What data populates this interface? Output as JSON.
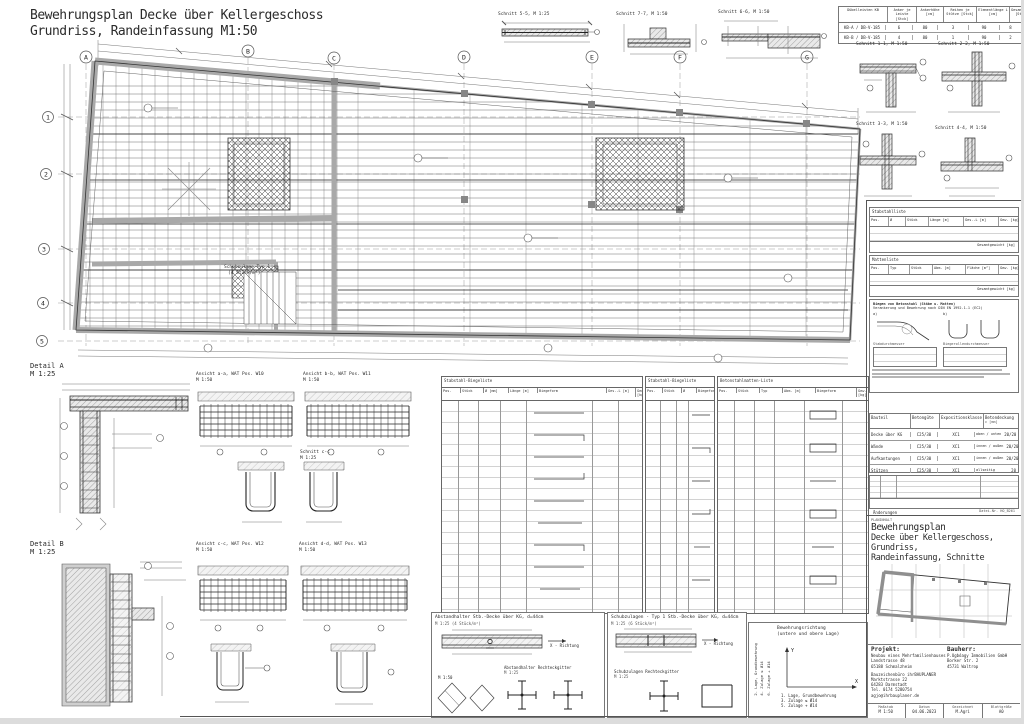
{
  "sheet": {
    "title1": "Bewehrungsplan Decke über Kellergeschoss",
    "title2": "Grundriss, Randeinfassung M1:50",
    "file_no": "Datei-Nr. HO_B261"
  },
  "plan": {
    "grid_top": [
      "A",
      "B",
      "C",
      "D",
      "E",
      "F",
      "G"
    ],
    "grid_left": [
      "1",
      "2",
      "3",
      "4",
      "5"
    ],
    "note1": "Schubzulage Typ 1",
    "note2": "(4 Stück/m²)"
  },
  "top_sections": [
    {
      "label": "Schnitt 5-5, M 1:25"
    },
    {
      "label": "Schnitt 7-7, M 1:50"
    },
    {
      "label": "Schnitt 6-6, M 1:50"
    }
  ],
  "right_sections": [
    {
      "label": "Schnitt 1-1, M 1:50"
    },
    {
      "label": "Schnitt 2-2, M 1:50"
    },
    {
      "label": "Schnitt 3-3, M 1:50"
    },
    {
      "label": "Schnitt 4-4, M 1:50"
    }
  ],
  "anchor_table": {
    "columns": [
      "Dübelleisten KB",
      "Anker je Leiste [Stck]",
      "Ankerhöhe [cm]",
      "Reihen je Stütze [Stck]",
      "Elementlänge L [cm]",
      "Gesamtzahl [Stck]"
    ],
    "rows": [
      [
        "KB-A / DB-V-185",
        "6",
        "80",
        "3",
        "90",
        "8"
      ],
      [
        "KB-B / DB-V-185",
        "4",
        "80",
        "1",
        "90",
        "2"
      ]
    ]
  },
  "left_details": {
    "detail_a_title": "Detail A",
    "detail_a_scale": "M 1:25",
    "detail_b_title": "Detail B",
    "detail_b_scale": "M 1:25",
    "ansicht_aa": "Ansicht a-a, WAT Pos. W10",
    "ansicht_aa_scale": "M 1:50",
    "ansicht_bb": "Ansicht b-b, WAT Pos. W11",
    "ansicht_bb_scale": "M 1:50",
    "schnitt_cc": "Schnitt c-c",
    "schnitt_cc_scale": "M 1:25",
    "ansicht_cc": "Ansicht c-c, WAT Pos. W12",
    "ansicht_cc_scale": "M 1:50",
    "ansicht_dd": "Ansicht d-d, WAT Pos. W13",
    "ansicht_dd_scale": "M 1:50"
  },
  "schedules": {
    "t1_title": "Stabstahl-Biegeliste",
    "t2_title": "Stabstahl-Biegeliste",
    "t3_title": "Betonstahlmatten-Liste",
    "headers": [
      "Pos.",
      "Stück",
      "Ø [mm]",
      "Länge [m]",
      "Biegeform",
      "Ges.-L [m]",
      "Gew. [kg]"
    ],
    "headers_short": [
      "Pos.",
      "Stück",
      "Ø",
      "Biegeform"
    ],
    "headers_matten": [
      "Pos.",
      "Stück",
      "Typ",
      "Abm. [m]",
      "Biegeform",
      "Gew. [kg]"
    ]
  },
  "bottom": {
    "box1_title": "Abstandhalter  Stb.-Decke über KG, d=44cm",
    "box1_scale": "M 1:25  (4 Stück/m²)",
    "box1_sub": "Abstandhalter Rechteckgitter",
    "box1_sub_scale": "M 1:25",
    "box2_title": "Schubzulagen - Typ 1 Stb.-Decke über KG, d=44cm",
    "box2_scale": "M 1:25  (6 Stück/m²)",
    "box2_sub": "Schubzulagen Rechteckgitter",
    "box2_sub_scale": "M 1:25",
    "x_richtung": "X - Richtung",
    "m150": "M 1:50"
  },
  "legend": {
    "title1": "Bewehrungsrichtung",
    "title2": "(untere und obere Lage)",
    "x": "X",
    "y": "Y",
    "x_lines": [
      "1. Lage, Grundbewehrung",
      "3. Zulage ≤ Ø14",
      "5. Zulage + Ø14"
    ],
    "y_lines": [
      "2. Lage, Grundbewehrung",
      "4. Zulage ≤ Ø14",
      "6. Zulage + Ø14"
    ]
  },
  "right_panel": {
    "stahlliste_title": "Stabstahlliste",
    "stahl_headers": [
      "Pos.",
      "Ø",
      "Stück",
      "Länge [m]",
      "Ges.-L [m]",
      "Gew. [kg]"
    ],
    "stahl_footer": "Gesamtgewicht [kg]",
    "mattenliste_title": "Mattenliste",
    "matten_headers": [
      "Pos.",
      "Typ",
      "Stück",
      "Abm. [m]",
      "Fläche [m²]",
      "Gew. [kg]"
    ],
    "matten_footer": "Gesamtgewicht [kg]",
    "biege_title1": "Biegen von Betonstahl (Stäbe u. Matten)",
    "biege_title2": "Verankerung und Bewehrung nach DIN EN 1992-1-1 (EC2)",
    "biege_a": "a)",
    "biege_b": "b)",
    "biege_t1": "Stabdurchmesser",
    "biege_t2": "Biegerollendurchmesser",
    "material": {
      "headers": [
        "Bauteil",
        "Betongüte",
        "Expositionsklasse",
        "Betondeckung"
      ],
      "sub": "c  [mm]",
      "rows": [
        [
          "Decke über KG",
          "C25/30",
          "XC1",
          "oben / unten",
          "20/20"
        ],
        [
          "Wände",
          "C25/30",
          "XC1",
          "innen / außen",
          "20/20"
        ],
        [
          "Aufkantungen",
          "C25/30",
          "XC1",
          "innen / außen",
          "20/20"
        ],
        [
          "Stützen",
          "C25/30",
          "XC1",
          "allseitig",
          "20"
        ]
      ]
    },
    "aenderungen": "Änderungen"
  },
  "titleblock": {
    "planinhalt": "PLANINHALT",
    "title1": "Bewehrungsplan",
    "title2": "Decke über Kellergeschoss, Grundriss,",
    "title3": "Randeinfassung, Schnitte",
    "projekt_label": "Projekt:",
    "projekt": [
      "Neubau eines Mehrfamilienhauses",
      "Landstrasse 48",
      "65188 Schmalzheim"
    ],
    "office": [
      "Bauzeichenbüro ihrBAUPLANER",
      "Marktstrasse 22",
      "64283 Darmstadt",
      "Tel. 0174 5280754",
      "agjo@ihrbauplaner.de"
    ],
    "bauherr_label": "Bauherr:",
    "bauherr": [
      "P.Ugbóagy Immobilien GmbH",
      "Borker Str. 2",
      "45731 Waltrop"
    ],
    "meta": [
      {
        "label": "Maßstab",
        "value": "M 1:50"
      },
      {
        "label": "Datum",
        "value": "04.06.2023"
      },
      {
        "label": "Gezeichnet",
        "value": "M.Agri"
      },
      {
        "label": "Blattgröße",
        "value": "A0"
      }
    ]
  }
}
